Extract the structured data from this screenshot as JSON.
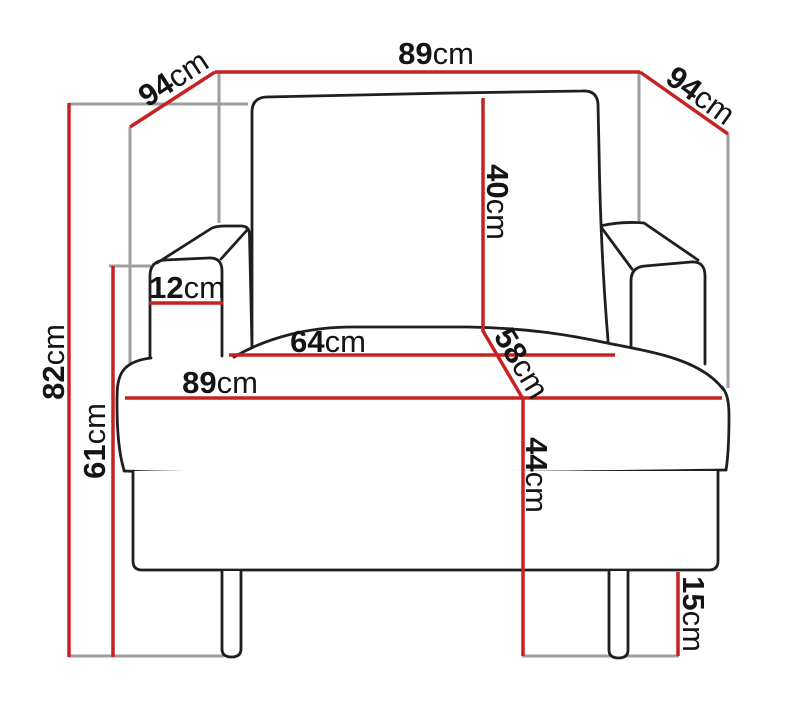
{
  "diagram": {
    "kind": "furniture-dimension-drawing",
    "subject": "armchair front view with measurements",
    "unit": "cm",
    "dimensions": [
      {
        "id": "overall-width-top",
        "value": "89",
        "unit": "cm",
        "orientation": "horizontal"
      },
      {
        "id": "depth-left",
        "value": "94",
        "unit": "cm",
        "orientation": "diagonal-left"
      },
      {
        "id": "depth-right",
        "value": "94",
        "unit": "cm",
        "orientation": "diagonal-right"
      },
      {
        "id": "backrest-height",
        "value": "40",
        "unit": "cm",
        "orientation": "vertical"
      },
      {
        "id": "seat-depth",
        "value": "58",
        "unit": "cm",
        "orientation": "diagonal"
      },
      {
        "id": "seat-height",
        "value": "44",
        "unit": "cm",
        "orientation": "vertical"
      },
      {
        "id": "seat-width",
        "value": "64",
        "unit": "cm",
        "orientation": "horizontal"
      },
      {
        "id": "overall-width-seat",
        "value": "89",
        "unit": "cm",
        "orientation": "horizontal"
      },
      {
        "id": "armrest-width",
        "value": "12",
        "unit": "cm",
        "orientation": "horizontal"
      },
      {
        "id": "overall-height",
        "value": "82",
        "unit": "cm",
        "orientation": "vertical"
      },
      {
        "id": "armrest-height",
        "value": "61",
        "unit": "cm",
        "orientation": "vertical"
      },
      {
        "id": "leg-height",
        "value": "15",
        "unit": "cm",
        "orientation": "vertical"
      }
    ],
    "colors": {
      "dimension_line": "#c62222",
      "helper_line": "#9e9e9e",
      "outline": "#1f1f1f",
      "label_text": "#141414",
      "background": "#ffffff"
    }
  }
}
